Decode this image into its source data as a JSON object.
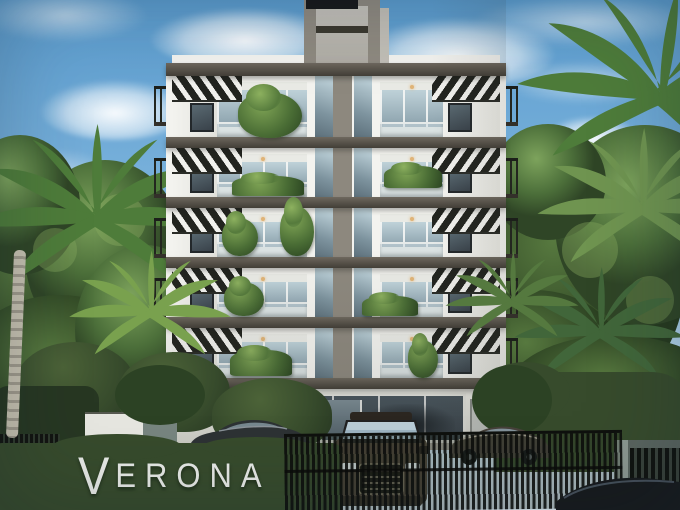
{
  "sign": {
    "initial": "V",
    "rest": "ERONA",
    "full_text": "VERONA"
  },
  "building": {
    "floors_visible": 6,
    "has_rooftop_core_tower": true
  },
  "vehicles_visible": 4,
  "scene": {
    "colors": {
      "sky_top": "#5b9cce",
      "sky_mid": "#7db4dd",
      "sky_low": "#b7d5e9",
      "horizon": "#dce9f1",
      "cloud_white": "#ffffff",
      "leaf_light": "#86ab5e",
      "leaf_mid": "#4c6f3a",
      "leaf_dark": "#2c4224",
      "palm_green": "#4e7c3a",
      "palm_light": "#79a14e",
      "trunk_light": "#c4bfae",
      "trunk_dark": "#9d988a",
      "facade_white": "#f3f3ef",
      "facade_shade": "#e2e2dc",
      "slab_top": "#6e685e",
      "slab_bottom": "#423e37",
      "tower_gray": "#8f8a80",
      "tower_panel": "#c6c3bc",
      "tower_cap": "#17181a",
      "glass_sky": "#bfd2d9",
      "glass_mid": "#8aa0ab",
      "glass_dark": "#39424a",
      "louver_dark": "#22241f",
      "louver_white": "#f1f1ed",
      "rail_dark": "#23261f",
      "hedge_green": "#374b2c",
      "hedge_dark": "#273722",
      "fence_dark": "#121410",
      "fence_gap": "#2f3a2d",
      "gate_bar": "#0f110e",
      "sign_white": "#e9ebe7",
      "suv_body": "#4c4236",
      "suv_glass": "#9db4c2",
      "sedan_left": "#2d3234",
      "sedan_right": "#46413a",
      "corner_car": "#171a1c",
      "drive_gray": "#b3afa6",
      "wall_white": "#e6e6e0",
      "garage_wall": "#5a655f"
    }
  }
}
